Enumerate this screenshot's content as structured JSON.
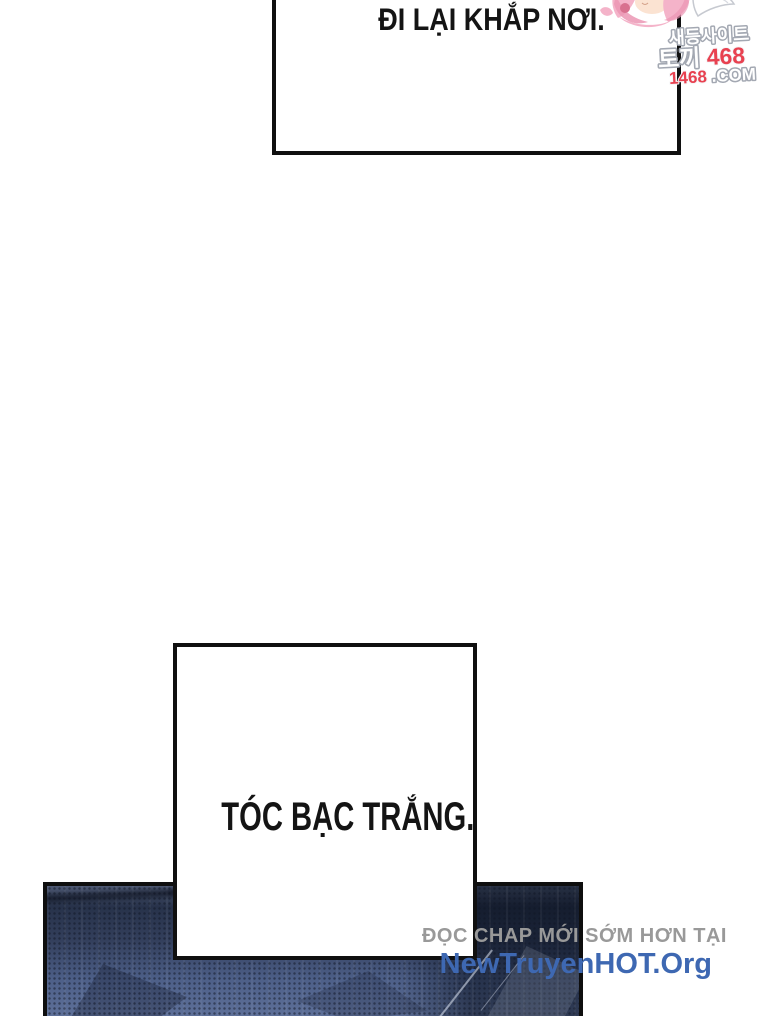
{
  "comic": {
    "speech_top": "ĐI LẠI KHẮP NƠI.",
    "speech_middle": "TÓC BẠC TRẮNG."
  },
  "watermark": {
    "line1": "새등사이트",
    "line2_prefix": "토끼",
    "line2_number": "468",
    "line3_number": "1468",
    "line3_suffix": ".COM",
    "red_color": "#e84150",
    "outline_color": "#a3a8b2"
  },
  "promo": {
    "line1": "ĐỌC CHAP MỚI SỚM HƠN TẠI",
    "line2": "NewTruyenHOT.Org",
    "line1_color": "#999999",
    "line2_color": "#3e68b2"
  },
  "artwork_colors": {
    "panel_top": "#27324a",
    "panel_bottom": "#5e7099",
    "border": "#0e0e0e"
  }
}
